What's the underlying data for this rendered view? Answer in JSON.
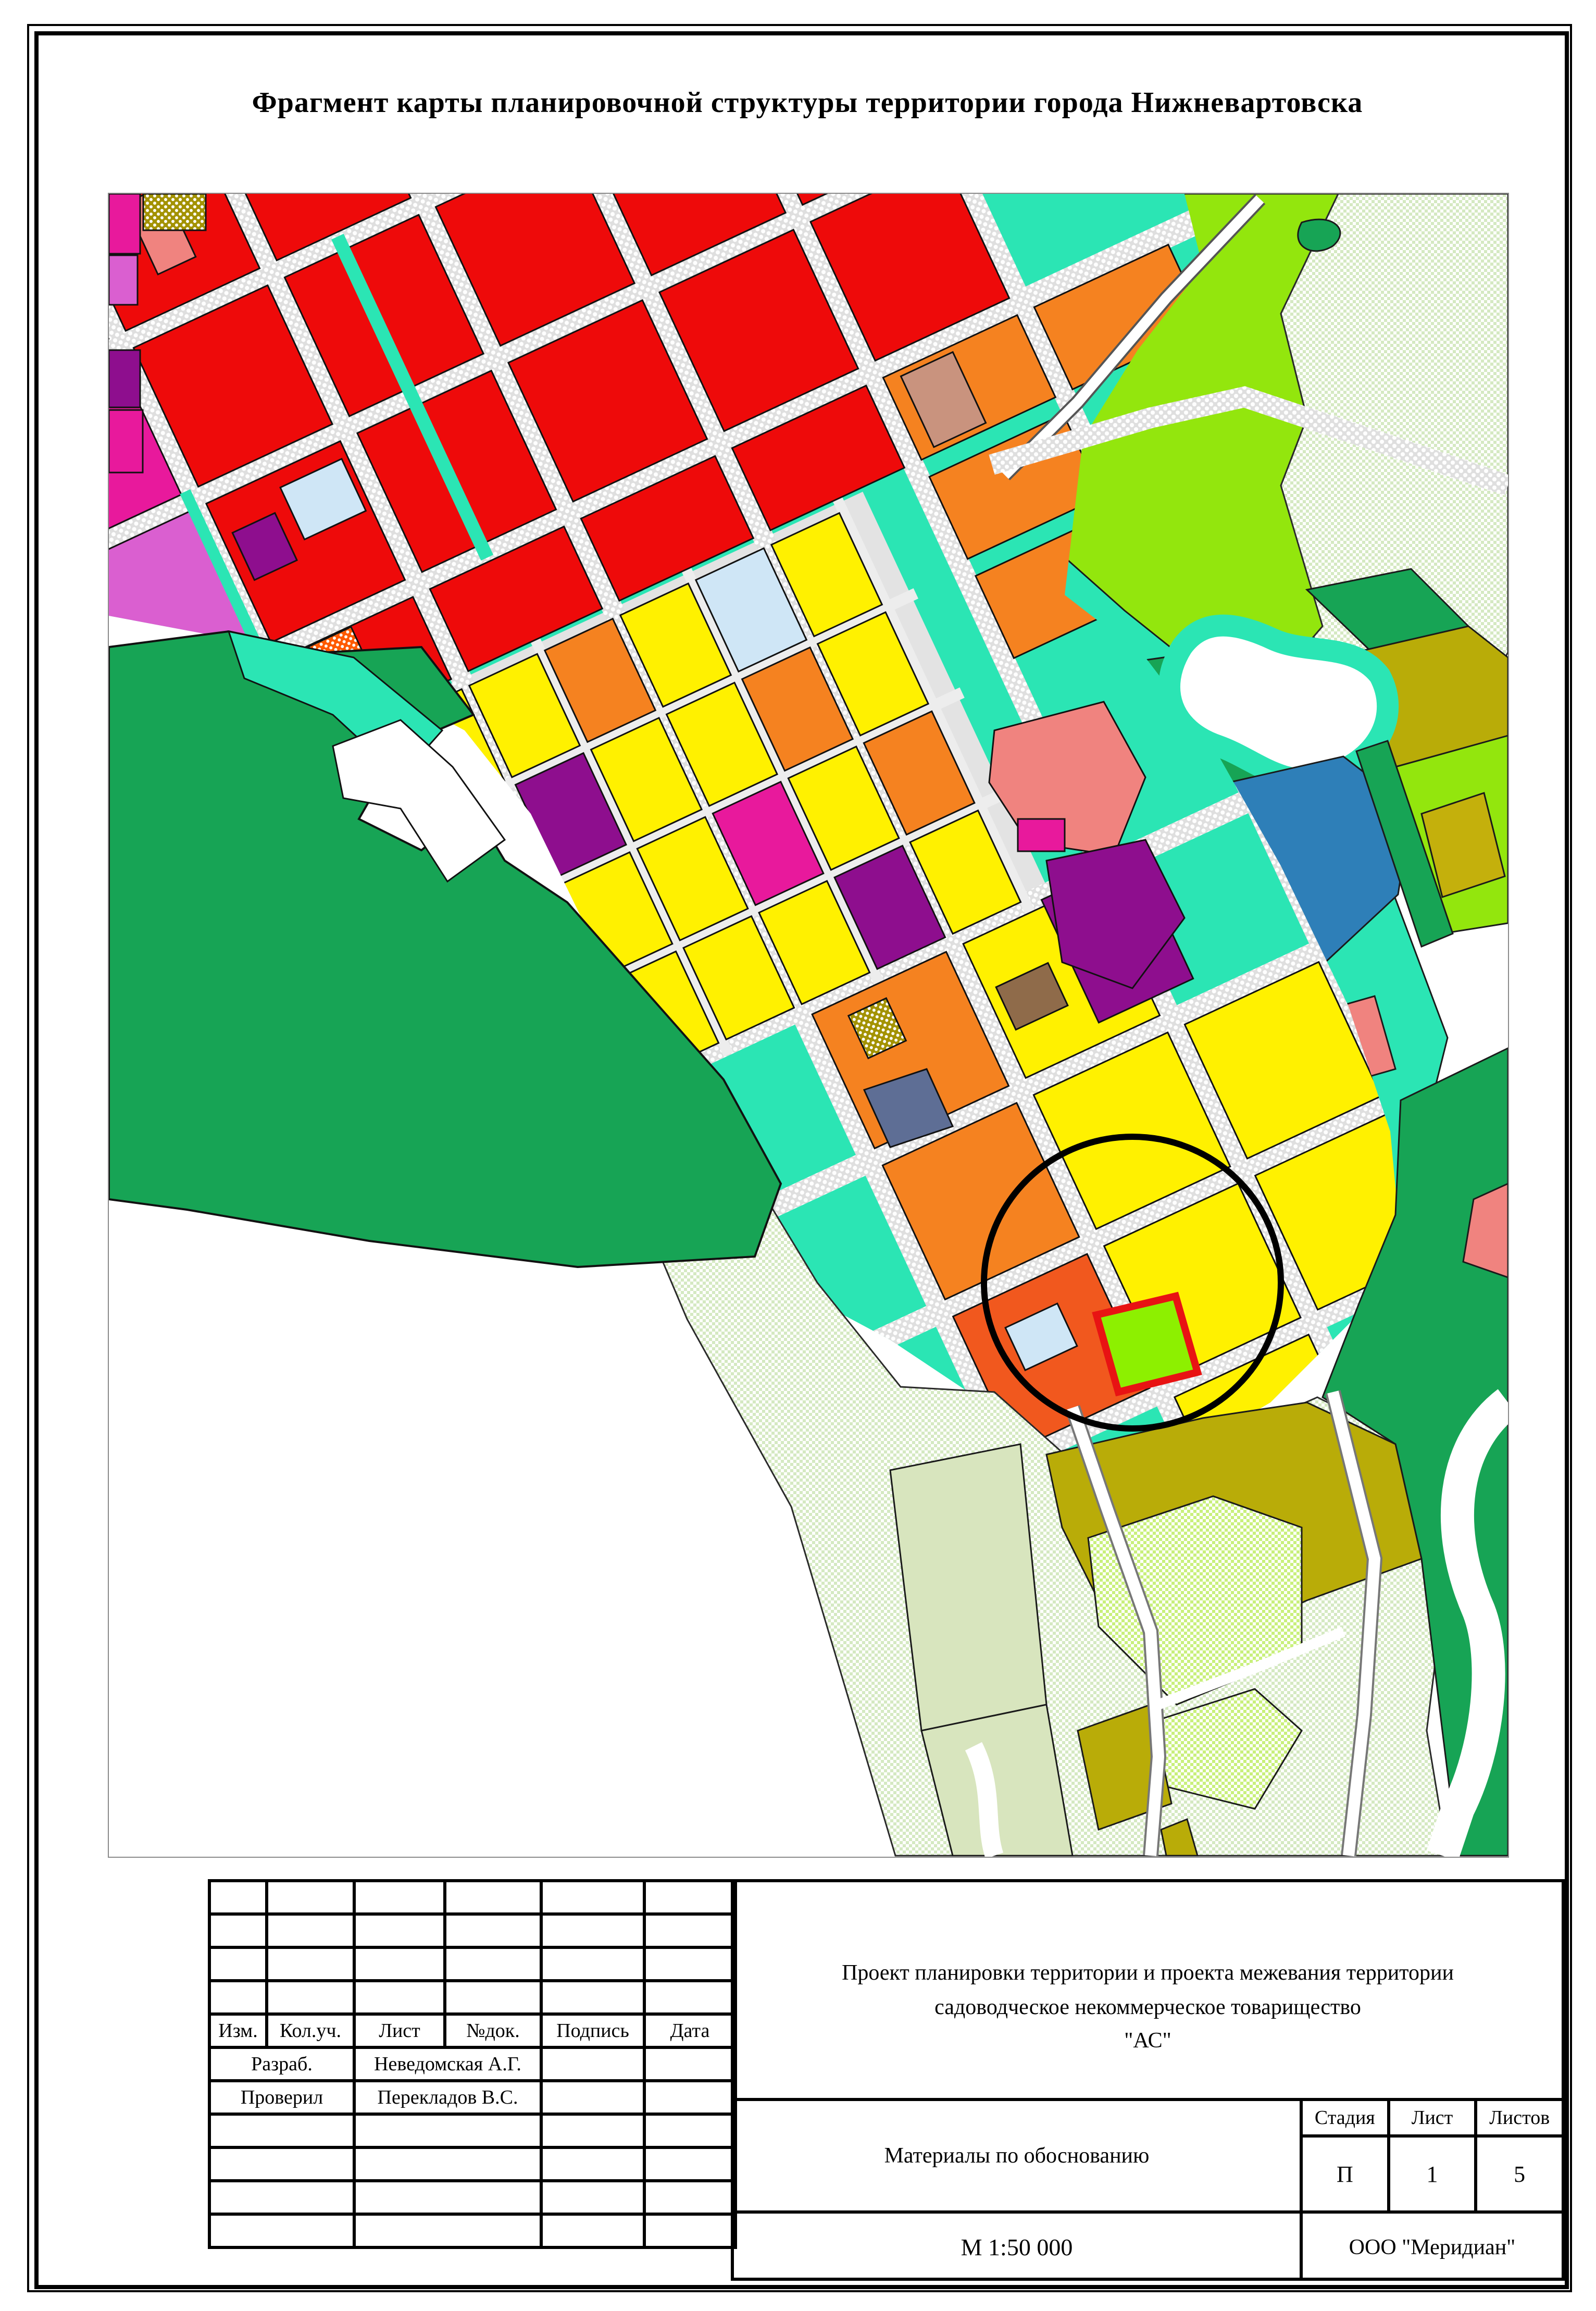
{
  "sheet": {
    "title": "Фрагмент карты планировочной структуры территории города Нижневартовска"
  },
  "title_block": {
    "header_columns": [
      "Изм.",
      "Кол.уч.",
      "Лист",
      "№док.",
      "Подпись",
      "Дата"
    ],
    "signature_rows": [
      {
        "label": "Разраб.",
        "name": "Неведомская А.Г."
      },
      {
        "label": "Проверил",
        "name": "Перекладов В.С."
      }
    ],
    "project_name_line1": "Проект планировки территории и проекта  межевания территории",
    "project_name_line2": "садоводческое некоммерческое товарищество",
    "project_name_line3": "\"АС\"",
    "document_title": "Материалы по обоснованию",
    "stage_label": "Стадия",
    "sheet_label": "Лист",
    "sheets_label": "Листов",
    "stage_value": "П",
    "sheet_value": "1",
    "sheets_value": "5",
    "scale": "М 1:50 000",
    "organization": "ООО \"Меридиан\""
  },
  "map": {
    "palette": {
      "red": "#EE0A0A",
      "yellow": "#FFF100",
      "orange": "#F58220",
      "dorange": "#F1581E",
      "teal": "#2BE5B4",
      "emerald": "#17A455",
      "chart": "#93E60D",
      "site": "#8DF000",
      "pale": "#D5E9C2",
      "bpale": "#C9F07C",
      "sage": "#D8E5BE",
      "olive": "#B9AC08",
      "mustard": "#C4B00C",
      "blue": "#2E7FB8",
      "lblue": "#CFE6F6",
      "magenta": "#E8199C",
      "orchid": "#DA5FD0",
      "purple": "#8E0E8E",
      "salmon": "#F0837F",
      "brown": "#8F6B4A",
      "tan": "#C9937E",
      "slate": "#5E6E95",
      "lav": "#DCD6F2",
      "khaki": "#A39200",
      "dotor": "#FF5A00",
      "road": "#DFDFDF",
      "gardenroad": "#E3E3E3",
      "white": "#FFFFFF",
      "black": "#000000",
      "sitered": "#E81313"
    }
  }
}
